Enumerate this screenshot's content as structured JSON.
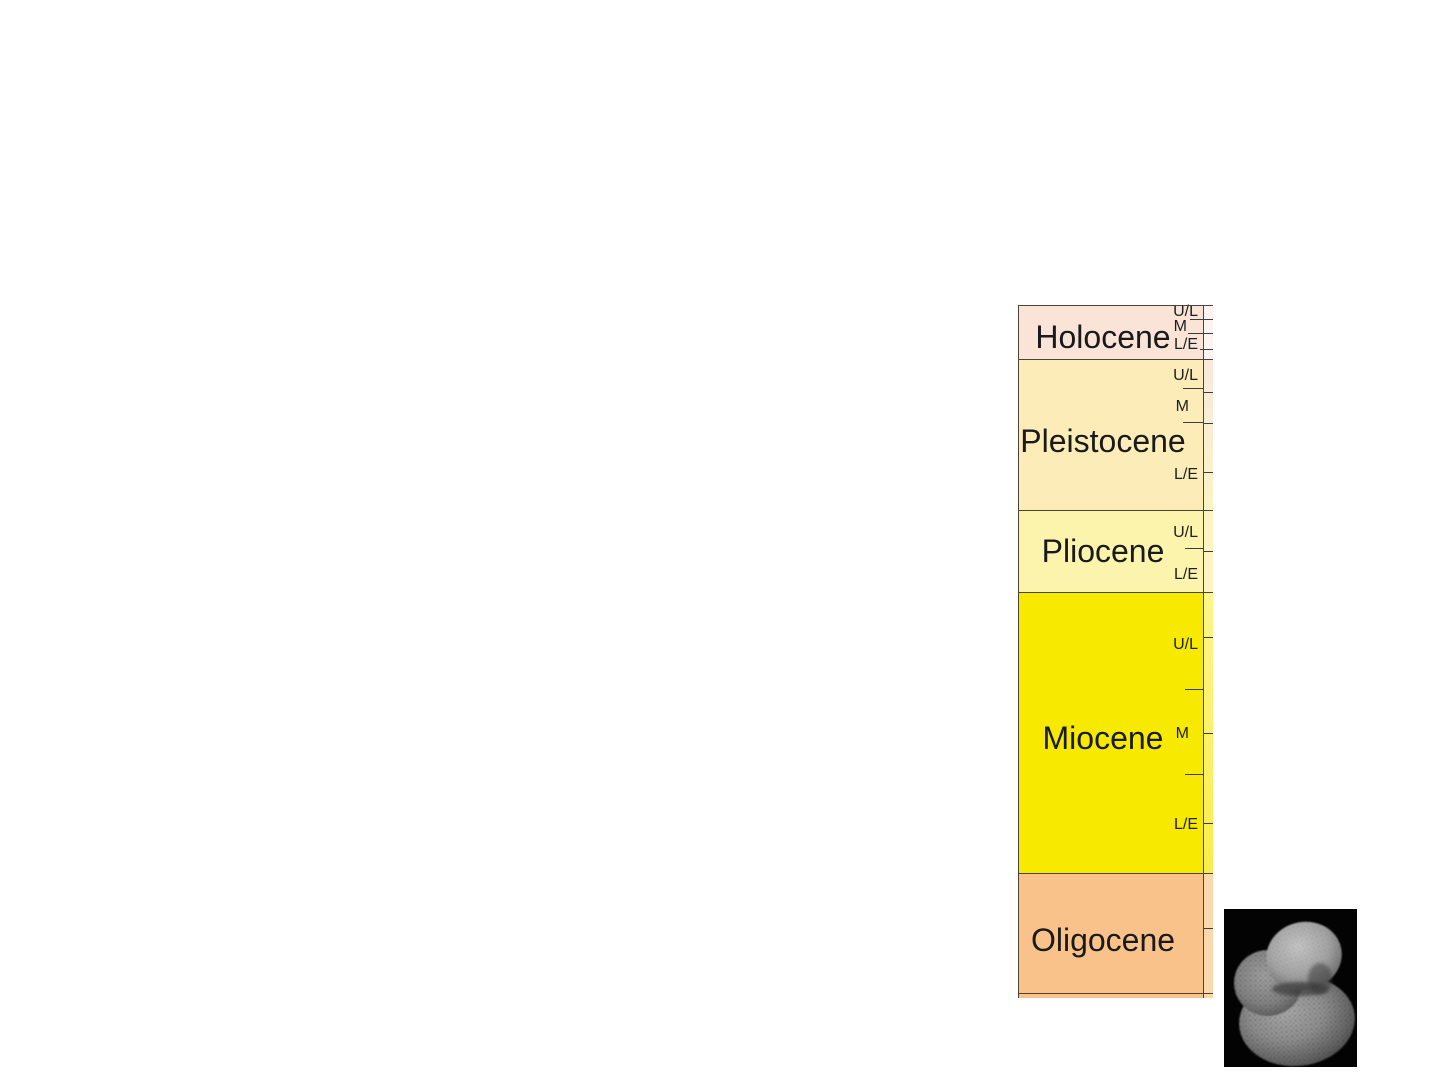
{
  "page": {
    "background": "#ffffff",
    "description_of_content": "Geologic epoch time column with sub-epoch divisions and a foraminifera SEM image"
  },
  "chart_data": {
    "type": "table",
    "title": "",
    "orientation": "vertical-stratigraphic-column",
    "columns": [
      "Epoch",
      "Sub-epoch divisions"
    ],
    "epoch_order_top_to_bottom": [
      "Holocene",
      "Pleistocene",
      "Pliocene",
      "Miocene",
      "Oligocene"
    ],
    "sub_epoch_labels_meaning": {
      "U/L": "Upper/Late",
      "M": "Middle",
      "L/E": "Lower/Early"
    },
    "geometry": {
      "left": 1018,
      "top": 305,
      "width": 195,
      "height": 693,
      "main_col_width": 185,
      "strip_width": 10
    },
    "line_colors": {
      "boundary": "#4b4336",
      "tick": "#3c3c3c"
    },
    "text_color": "#1a1a1a",
    "epochs": [
      {
        "name": "Holocene",
        "fill": "#fae4d7",
        "strip_fill": "#fdf3f0",
        "strip_fill2": "#fdf3f0",
        "top": 0,
        "height": 54,
        "label_cy": 32,
        "sublabels": [
          {
            "text": "U/L",
            "cy": 7,
            "right": 15
          },
          {
            "text": "M",
            "cy": 22,
            "right": 26
          },
          {
            "text": "L/E",
            "cy": 40,
            "right": 15
          }
        ],
        "column_ticks": [
          {
            "y": 14,
            "x1": 172,
            "x2": 195
          },
          {
            "y": 28,
            "x1": 170,
            "x2": 195
          },
          {
            "y": 44,
            "x1": 182,
            "x2": 195
          }
        ],
        "strip_ticks": []
      },
      {
        "name": "Pleistocene",
        "fill": "#fbecb8",
        "strip_fill": "#f8eade",
        "strip_fill2": "#fbf2c4",
        "top": 54,
        "height": 151,
        "label_cy": 136,
        "sublabels": [
          {
            "text": "U/L",
            "cy": 71,
            "right": 15
          },
          {
            "text": "M",
            "cy": 102,
            "right": 24
          },
          {
            "text": "L/E",
            "cy": 170,
            "right": 15
          }
        ],
        "column_ticks": [
          {
            "y": 83,
            "x1": 165,
            "x2": 185
          },
          {
            "y": 117,
            "x1": 165,
            "x2": 185
          }
        ],
        "strip_ticks": [
          87,
          118,
          167
        ]
      },
      {
        "name": "Pliocene",
        "fill": "#fcf4ac",
        "strip_fill": "#fcf5c2",
        "strip_fill2": "#fcf5c2",
        "top": 205,
        "height": 82,
        "label_cy": 246,
        "sublabels": [
          {
            "text": "U/L",
            "cy": 228,
            "right": 15
          },
          {
            "text": "L/E",
            "cy": 270,
            "right": 15
          }
        ],
        "column_ticks": [
          {
            "y": 243,
            "x1": 167,
            "x2": 185
          }
        ],
        "strip_ticks": [
          246
        ]
      },
      {
        "name": "Miocene",
        "fill": "#f7ea00",
        "strip_fill": "#fdf68a",
        "strip_fill2": "#f9ed4c",
        "top": 287,
        "height": 281,
        "label_cy": 433,
        "sublabels": [
          {
            "text": "U/L",
            "cy": 340,
            "right": 15
          },
          {
            "text": "M",
            "cy": 429,
            "right": 24
          },
          {
            "text": "L/E",
            "cy": 520,
            "right": 15
          }
        ],
        "column_ticks": [
          {
            "y": 384,
            "x1": 167,
            "x2": 185
          },
          {
            "y": 469,
            "x1": 167,
            "x2": 185
          }
        ],
        "strip_ticks": [
          332,
          428,
          518
        ]
      },
      {
        "name": "Oligocene",
        "fill": "#f9c28b",
        "strip_fill": "#fbd9ad",
        "strip_fill2": "#fbd9ad",
        "top": 568,
        "height": 120,
        "label_cy": 635,
        "sublabels": [],
        "column_ticks": [],
        "strip_ticks": [
          623
        ]
      }
    ],
    "bottom_partial_row": {
      "line_y": 688,
      "fill": "#f9c28b",
      "strip_fill": "#fbd9ad",
      "height": 5
    },
    "boundary_lines_y": [
      0,
      54,
      205,
      287,
      568,
      688
    ],
    "vertical_separator_x": 185
  },
  "foram_image": {
    "semantic": "scanning-electron-micrograph-of-planktic-foraminifera",
    "geometry": {
      "left": 1224,
      "top": 909,
      "width": 133,
      "height": 158
    },
    "background": "#030303",
    "shell_gray_light": "#c3c3c3",
    "shell_gray_mid": "#8f8f8f",
    "shell_gray_dark": "#454545"
  }
}
